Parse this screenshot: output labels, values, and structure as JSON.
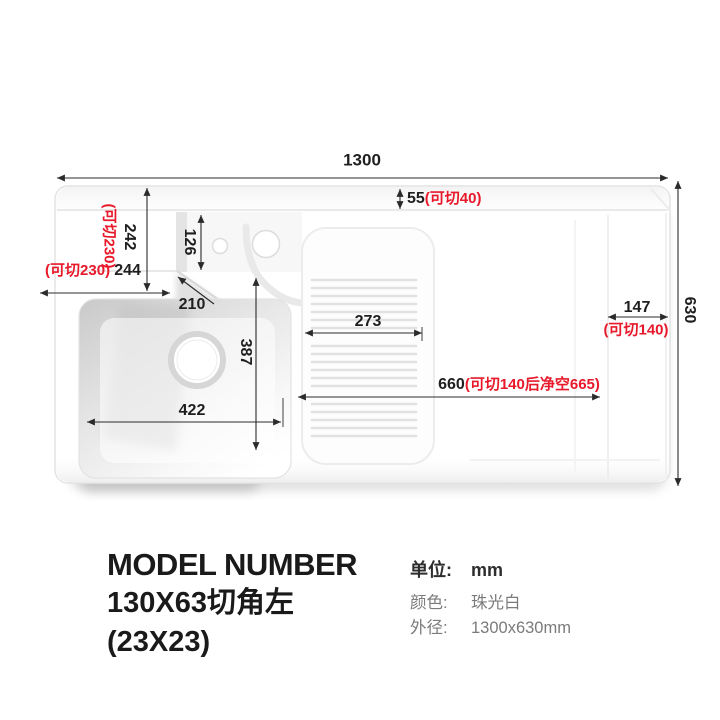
{
  "colors": {
    "annotation_red": "#e8192a",
    "dimension_text": "#1f1f1f",
    "secondary_text": "#7b7b7b"
  },
  "drawing": {
    "total_width": "1300",
    "total_height": "630",
    "top_rim": {
      "value": "55",
      "cut": "(可切40)"
    },
    "back_left_height": {
      "cut": "(可切230)",
      "value": "242"
    },
    "back_left_width": {
      "cut": "(可切230)",
      "value": "244"
    },
    "shelf_depth": "126",
    "corner_diagonal": "210",
    "washboard_width": "273",
    "bowl_height": "387",
    "bowl_width": "422",
    "clear_span": {
      "value": "660",
      "cut": "(可切140后净空665)"
    },
    "right_ledge": {
      "value": "147",
      "cut": "(可切140)"
    }
  },
  "footer": {
    "heading": "MODEL NUMBER",
    "model": "130X63切角左",
    "corner_spec": "(23X23)",
    "specs": [
      {
        "label": "单位:",
        "value": "mm"
      },
      {
        "label": "颜色:",
        "value": "珠光白"
      },
      {
        "label": "外径:",
        "value": "1300x630mm"
      }
    ]
  }
}
